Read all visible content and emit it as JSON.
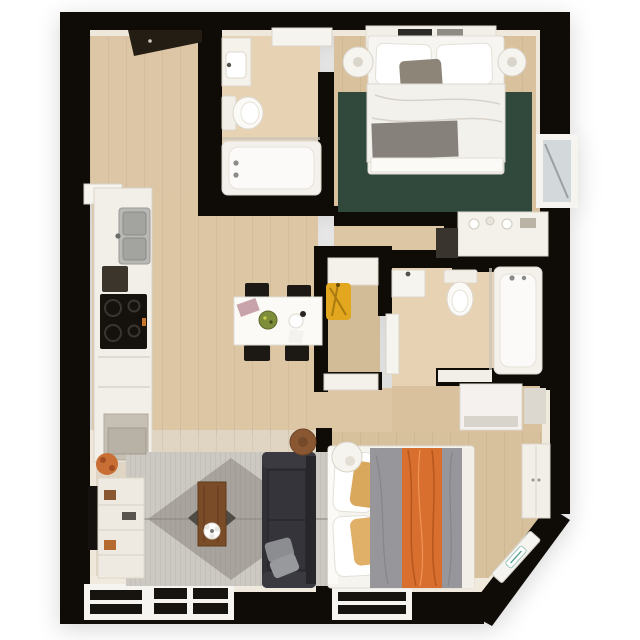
{
  "scene": {
    "type": "3d-floor-plan-top-view",
    "description": "Photorealistic 3D top-down floor plan of a two-bedroom apartment, black walls on white background, no text labels",
    "background": "#ffffff"
  },
  "palette": {
    "wall": "#0f0c08",
    "floor_wood": "#d9c3a0",
    "floor_bath": "#e7d3b4",
    "floor_living": "#e0d5c2",
    "inner_wall_face": "#f0e9dd",
    "fixture_white": "#f5f2ec",
    "rug_green": "#31493c",
    "rug_gray": "#ccc9c2",
    "diamond_gray": "#a8a49d",
    "diamond_dark": "#4e4b45",
    "sofa_charcoal": "#303036",
    "accent_orange": "#d96f2e",
    "accent_yellow": "#e2a71e",
    "wood_brown": "#7a4c28",
    "pillow_tan": "#d9a85c",
    "duvet_gray": "#97979b"
  },
  "rooms": [
    {
      "name": "entry-hall",
      "furniture": [
        "corner wardrobe",
        "entry door"
      ]
    },
    {
      "name": "bathroom-1",
      "furniture": [
        "vanity sink",
        "toilet",
        "bathtub",
        "glass screen",
        "door"
      ]
    },
    {
      "name": "bedroom-1",
      "furniture": [
        "double bed",
        "headboard shelf with books",
        "round nightstand left",
        "round nightstand right",
        "green rug",
        "gray throw",
        "dresser with decor",
        "side window"
      ]
    },
    {
      "name": "kitchen",
      "furniture": [
        "counter run",
        "double sink",
        "cooktop",
        "small appliance",
        "base cabinet"
      ]
    },
    {
      "name": "dining-area",
      "furniture": [
        "white table",
        "four black chairs",
        "salad bowl",
        "teapot",
        "pink cloth",
        "napkin"
      ]
    },
    {
      "name": "hall-closet",
      "furniture": [
        "top shelf",
        "yellow jacket",
        "folding door"
      ]
    },
    {
      "name": "bathroom-2",
      "furniture": [
        "wall sink",
        "toilet",
        "bathtub with glass screen",
        "door",
        "storage cabinet",
        "counter shelf"
      ]
    },
    {
      "name": "living-room",
      "furniture": [
        "striped rug with diamond medallion",
        "wood coffee table with flowers",
        "charcoal sofa",
        "two gray pillows",
        "round side table",
        "wall TV",
        "media shelf",
        "orange plant",
        "window left",
        "window right"
      ]
    },
    {
      "name": "bedroom-2",
      "furniture": [
        "double bed",
        "gray duvet",
        "orange throw",
        "tan pillows",
        "round nightstand",
        "wardrobe",
        "radiator on angled wall",
        "window"
      ]
    }
  ],
  "window_count": 4,
  "door_count": 4
}
